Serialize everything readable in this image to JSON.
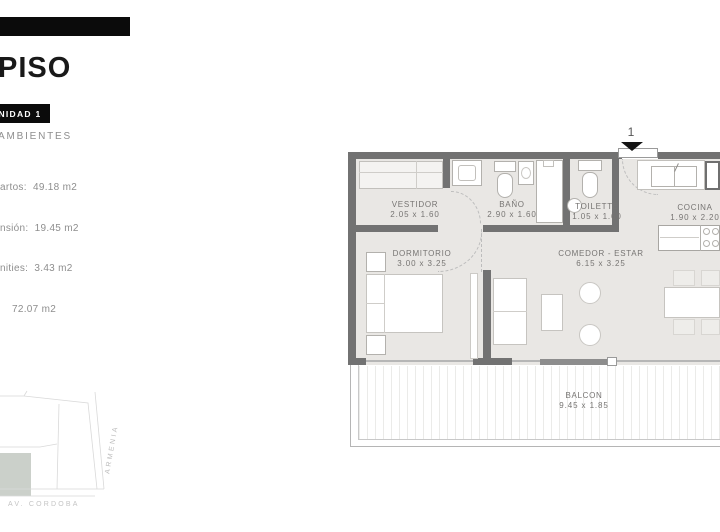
{
  "header": {
    "piso_title": "PISO",
    "unidad_badge": "UNIDAD 1",
    "ambientes_label": "AMBIENTES",
    "specs": [
      "artos:  49.18 m2",
      "nsión:  19.45 m2",
      "nities:  3.43 m2",
      "72.07 m2"
    ]
  },
  "floorplan": {
    "entry_marker": "1",
    "rooms": [
      {
        "name": "VESTIDOR",
        "dims": "2.05 x 1.60"
      },
      {
        "name": "BAÑO",
        "dims": "2.90 x 1.60"
      },
      {
        "name": "TOILETTE",
        "dims": "1.05 x 1.60"
      },
      {
        "name": "COCINA",
        "dims": "1.90 x 2.20"
      },
      {
        "name": "DORMITORIO",
        "dims": "3.00 x 3.25"
      },
      {
        "name": "COMEDOR - ESTAR",
        "dims": "6.15 x 3.25"
      },
      {
        "name": "BALCON",
        "dims": "9.45 x 1.85"
      }
    ]
  },
  "sitemap": {
    "street_diagonal": "ARMENIA",
    "street_bottom": "AV. CORDOBA"
  },
  "colors": {
    "accent_black": "#0b0b0b",
    "wall_gray": "#727272",
    "floor_gray": "#e9e7e4",
    "lot_fill": "#cbd0ca"
  }
}
